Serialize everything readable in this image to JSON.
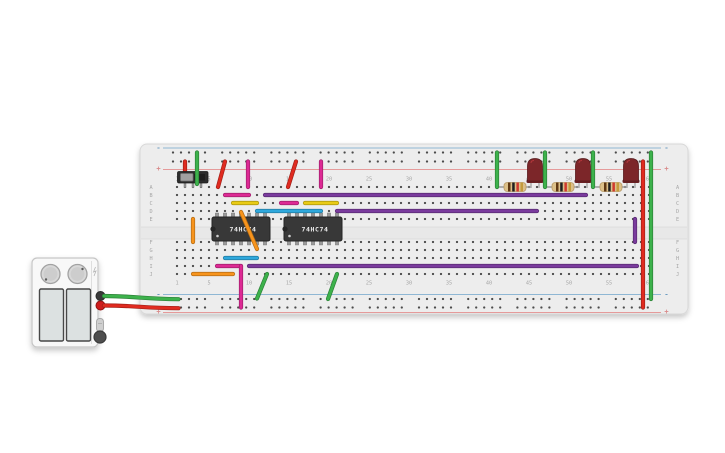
{
  "scene": {
    "width": 725,
    "height": 453,
    "background": "#ffffff"
  },
  "colors": {
    "red": "#e02b20",
    "green": "#3db24c",
    "magenta": "#dd2a94",
    "purple": "#7a3b9d",
    "yellow": "#e9cb15",
    "cyan": "#2fa8dc",
    "orange": "#f7941d",
    "rail_blue": "#8fb7d4",
    "rail_red": "#e59a9a",
    "board": "#ededed",
    "hole": "#4b4b4b",
    "label": "#a6a6a6",
    "ic_body": "#383838",
    "led": "#7c2629",
    "resistor_body": "#dcc089"
  },
  "breadboard": {
    "x": 140,
    "y": 144,
    "width": 548,
    "height": 170,
    "row_labels": [
      "A",
      "B",
      "C",
      "D",
      "E",
      "F",
      "G",
      "H",
      "I",
      "J"
    ],
    "row_y": [
      187,
      195,
      203,
      211,
      219,
      242,
      250,
      258,
      266,
      274
    ],
    "col_labels": [
      "1",
      "5",
      "10",
      "15",
      "20",
      "25",
      "30",
      "35",
      "40",
      "45",
      "50",
      "55",
      "60"
    ],
    "col_label_cols": [
      1,
      5,
      10,
      15,
      20,
      25,
      30,
      35,
      40,
      45,
      50,
      55,
      60
    ],
    "col_x0": 169,
    "col_pitch": 8,
    "cols": 60,
    "top_label_y": 180.5,
    "bottom_label_y": 284.5,
    "left_label_x": 151,
    "right_label_x": 677.5,
    "gap": {
      "y": 227,
      "height": 12
    },
    "rails": {
      "minus_label": "-",
      "plus_label": "+",
      "top_minus_y": 152.5,
      "top_plus_y": 161.5,
      "bottom_minus_y": 299,
      "bottom_plus_y": 307.5,
      "top_blue_line_y": 148,
      "top_red_line_y": 169.5,
      "bottom_blue_line_y": 294.5,
      "bottom_red_line_y": 312.5,
      "hole_x0": 173,
      "group_period": 49.2,
      "groups": 10,
      "holes_per_group": 5,
      "hole_pitch": 8,
      "line_x1": 163,
      "line_x2": 661,
      "left_label_x": 158.5,
      "right_label_x": 666.5
    }
  },
  "power_supply": {
    "body": {
      "x": 32,
      "y": 258,
      "width": 66,
      "height": 89
    },
    "seam_x": 91.5,
    "knobs": [
      {
        "cx": 50.5,
        "cy": 274,
        "r": 9.5,
        "dot_x": 46,
        "dot_y": 279.5
      },
      {
        "cx": 77.5,
        "cy": 274,
        "r": 9.5,
        "dot_x": 82.5,
        "dot_y": 269
      }
    ],
    "displays": [
      {
        "x": 39.5,
        "y": 289,
        "width": 24,
        "height": 52
      },
      {
        "x": 66.5,
        "y": 289,
        "width": 24,
        "height": 52
      }
    ],
    "terminals": [
      {
        "cx": 100.5,
        "cy": 296,
        "r": 4.5,
        "color": "#3a3a3a",
        "name": "negative-terminal"
      },
      {
        "cx": 100.5,
        "cy": 305.5,
        "r": 4.5,
        "color": "#cf1d1d",
        "name": "positive-terminal"
      }
    ],
    "switch_pill": {
      "x": 96.5,
      "y": 318.5,
      "width": 7,
      "height": 13
    },
    "power_button": {
      "cx": 100,
      "cy": 337,
      "r": 6
    }
  },
  "components": {
    "slide_switch": {
      "x": 177.5,
      "y": 171.5,
      "width": 30.5,
      "height": 11.5,
      "knob": {
        "x": 180.5,
        "y": 173.5,
        "width": 12.5,
        "height": 7.5
      },
      "pins_x": [
        185,
        193,
        201
      ],
      "pin_y1": 182.5,
      "pin_y2": 187
    },
    "ics": [
      {
        "label": "74HC74",
        "body": {
          "x": 212,
          "y": 217,
          "width": 58,
          "height": 24
        },
        "pin_x": [
          217,
          225,
          233,
          241,
          249,
          257,
          265
        ]
      },
      {
        "label": "74HC74",
        "body": {
          "x": 284,
          "y": 217,
          "width": 58,
          "height": 24
        },
        "pin_x": [
          289,
          297,
          305,
          313,
          321,
          329,
          337
        ]
      }
    ],
    "resistors": [
      {
        "x1": 499,
        "x2": 531,
        "y": 187
      },
      {
        "x1": 547,
        "x2": 579,
        "y": 187
      },
      {
        "x1": 595,
        "x2": 627,
        "y": 187
      }
    ],
    "resistor_bands": [
      "#5f3813",
      "#1f1f1f",
      "#d03a2f",
      "#c49b3c"
    ],
    "leds": [
      {
        "cx": 535,
        "pin_y": 187
      },
      {
        "cx": 583,
        "pin_y": 187
      },
      {
        "cx": 631,
        "pin_y": 187
      }
    ]
  },
  "wires": [
    {
      "name": "wire-red-rail-to-switch",
      "color": "red",
      "x1": 185,
      "y1": 161.5,
      "x2": 185,
      "y2": 174,
      "layer": "under"
    },
    {
      "name": "wire-green-rail-to-switch",
      "color": "green",
      "x1": 197,
      "y1": 152.5,
      "x2": 197,
      "y2": 184
    },
    {
      "name": "wire-red-rail-to-a6",
      "color": "red",
      "x1": 225,
      "y1": 161.5,
      "x2": 218,
      "y2": 187
    },
    {
      "name": "wire-magenta-rail-to-a10",
      "color": "magenta",
      "x1": 248,
      "y1": 161.5,
      "x2": 248,
      "y2": 187
    },
    {
      "name": "wire-red-rail-to-a15",
      "color": "red",
      "x1": 296,
      "y1": 161.5,
      "x2": 288,
      "y2": 187
    },
    {
      "name": "wire-magenta-rail-to-a19",
      "color": "magenta",
      "x1": 321,
      "y1": 161.5,
      "x2": 321,
      "y2": 187
    },
    {
      "name": "wire-green-rail-to-a41",
      "color": "green",
      "x1": 497,
      "y1": 152.5,
      "x2": 497,
      "y2": 187
    },
    {
      "name": "wire-green-rail-to-a47",
      "color": "green",
      "x1": 545,
      "y1": 152.5,
      "x2": 545,
      "y2": 187
    },
    {
      "name": "wire-green-rail-to-a53",
      "color": "green",
      "x1": 593,
      "y1": 152.5,
      "x2": 593,
      "y2": 187
    },
    {
      "name": "wire-red-vertical-right",
      "color": "red",
      "x1": 643,
      "y1": 161.5,
      "x2": 643,
      "y2": 307.5
    },
    {
      "name": "wire-green-vertical-right",
      "color": "green",
      "x1": 651,
      "y1": 152.5,
      "x2": 651,
      "y2": 299
    },
    {
      "name": "wire-magenta-row-b",
      "color": "magenta",
      "x1": 225,
      "y1": 195,
      "x2": 249,
      "y2": 195
    },
    {
      "name": "wire-purple-row-b",
      "color": "purple",
      "x1": 265,
      "y1": 195,
      "x2": 586,
      "y2": 195
    },
    {
      "name": "wire-yellow-row-c-1",
      "color": "yellow",
      "x1": 233,
      "y1": 203,
      "x2": 257,
      "y2": 203
    },
    {
      "name": "wire-magenta-row-c",
      "color": "magenta",
      "x1": 281,
      "y1": 203,
      "x2": 297,
      "y2": 203
    },
    {
      "name": "wire-yellow-row-c-2",
      "color": "yellow",
      "x1": 305,
      "y1": 203,
      "x2": 337,
      "y2": 203
    },
    {
      "name": "wire-cyan-row-d",
      "color": "cyan",
      "x1": 257,
      "y1": 211,
      "x2": 321,
      "y2": 211
    },
    {
      "name": "wire-purple-row-d",
      "color": "purple",
      "x1": 337,
      "y1": 211,
      "x2": 537,
      "y2": 211
    },
    {
      "name": "wire-orange-vertical-e-f",
      "color": "orange",
      "x1": 193,
      "y1": 219,
      "x2": 193,
      "y2": 242
    },
    {
      "name": "wire-orange-diagonal",
      "color": "orange",
      "x1": 241,
      "y1": 212,
      "x2": 257,
      "y2": 249,
      "layer": "over"
    },
    {
      "name": "wire-purple-vertical-right",
      "color": "purple",
      "x1": 635,
      "y1": 219,
      "x2": 635,
      "y2": 242
    },
    {
      "name": "wire-cyan-row-h",
      "color": "cyan",
      "x1": 225,
      "y1": 258,
      "x2": 257,
      "y2": 258
    },
    {
      "name": "wire-magenta-row-i",
      "color": "magenta",
      "x1": 217,
      "y1": 266,
      "x2": 241,
      "y2": 266
    },
    {
      "name": "wire-purple-row-i",
      "color": "purple",
      "x1": 249,
      "y1": 266,
      "x2": 637,
      "y2": 266
    },
    {
      "name": "wire-orange-row-j",
      "color": "orange",
      "x1": 193,
      "y1": 274,
      "x2": 233,
      "y2": 274
    },
    {
      "name": "wire-magenta-vertical-bottom",
      "color": "magenta",
      "x1": 241,
      "y1": 266,
      "x2": 241,
      "y2": 307.5
    },
    {
      "name": "wire-green-diagonal-1",
      "color": "green",
      "x1": 257,
      "y1": 298.5,
      "x2": 267,
      "y2": 274
    },
    {
      "name": "wire-green-diagonal-2",
      "color": "green",
      "x1": 328,
      "y1": 299,
      "x2": 337,
      "y2": 274
    },
    {
      "name": "wire-supply-green",
      "color": "green",
      "path": "M104,296 C138,296.2 142,299 178.5,299.2"
    },
    {
      "name": "wire-supply-red",
      "color": "red",
      "path": "M104,305.5 C138,305.6 142,308 178.5,308.2"
    }
  ]
}
